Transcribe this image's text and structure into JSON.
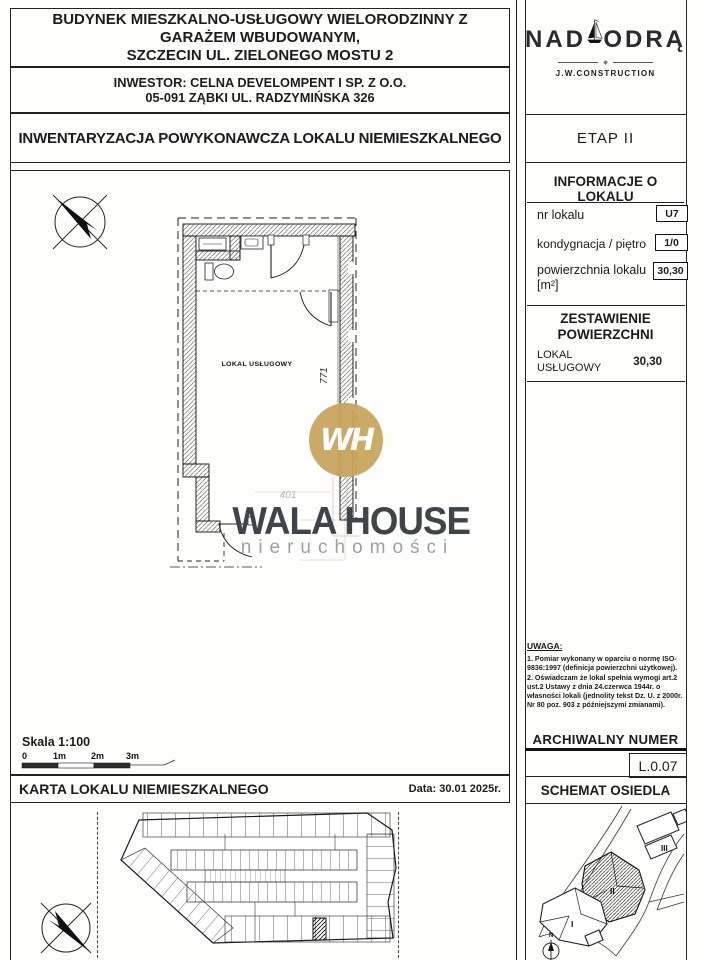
{
  "header": {
    "building_line1": "BUDYNEK MIESZKALNO-USŁUGOWY WIELORODZINNY Z",
    "building_line2": "GARAŻEM WBUDOWANYM,",
    "building_line3": "SZCZECIN UL. ZIELONEGO MOSTU 2",
    "investor_line1": "INWESTOR: CELNA DEVELOMPENT I SP. Z O.O.",
    "investor_line2": "05-091 ZĄBKI UL. RADZYMIŃSKA 326",
    "document_title": "INWENTARYZACJA POWYKONAWCZA LOKALU NIEMIESZKALNEGO"
  },
  "logo": {
    "nad": "NAD",
    "odra": "ODRĄ",
    "ornament": "◆",
    "company": "J.W.CONSTRUCTION"
  },
  "stage": {
    "label": "ETAP II"
  },
  "info": {
    "title": "INFORMACJE O LOKALU",
    "rows": [
      {
        "label": "nr lokalu",
        "value": "U7"
      },
      {
        "label": "kondygnacja / piętro",
        "value": "1/0"
      },
      {
        "label": "powierzchnia lokalu [m²]",
        "value": "30,30"
      }
    ]
  },
  "summary": {
    "title_line1": "ZESTAWIENIE",
    "title_line2": "POWIERZCHNI",
    "item_label": "LOKAL USŁUGOWY",
    "item_value": "30,30"
  },
  "notes": {
    "title": "UWAGA:",
    "item1": "1. Pomiar wykonany w oparciu o normę ISO-9836:1997 (definicja powierzchni użytkowej).",
    "item2": "2. Oświadczam że lokal spełnia wymogi art.2 ust.2 Ustawy z dnia 24.czerwca 1944r. o własności lokali (jednolity tekst Dz. U. z 2000r. Nr 80 poz. 903 z późniejszymi zmianami)."
  },
  "archive": {
    "title": "ARCHIWALNY NUMER",
    "number": "L.0.07"
  },
  "plan": {
    "room_label": "LOKAL USŁUGOWY",
    "dim_height": "771",
    "dim_width": "401"
  },
  "scalebar": {
    "label": "Skala 1:100",
    "ticks": [
      "0",
      "1m",
      "2m",
      "3m"
    ]
  },
  "footer": {
    "card_title": "KARTA LOKALU NIEMIESZKALNEGO",
    "date": "Data: 30.01 2025r."
  },
  "site": {
    "title": "SCHEMAT OSIEDLA",
    "north": "N",
    "building1": "I",
    "building2": "II",
    "building3": "III"
  },
  "watermark": {
    "monogram": "WH",
    "name": "WALA HOUSE",
    "subtitle": "nieruchomości",
    "gold": "#c8a35b",
    "dark": "#3f4449",
    "gray": "#9da1a4"
  }
}
